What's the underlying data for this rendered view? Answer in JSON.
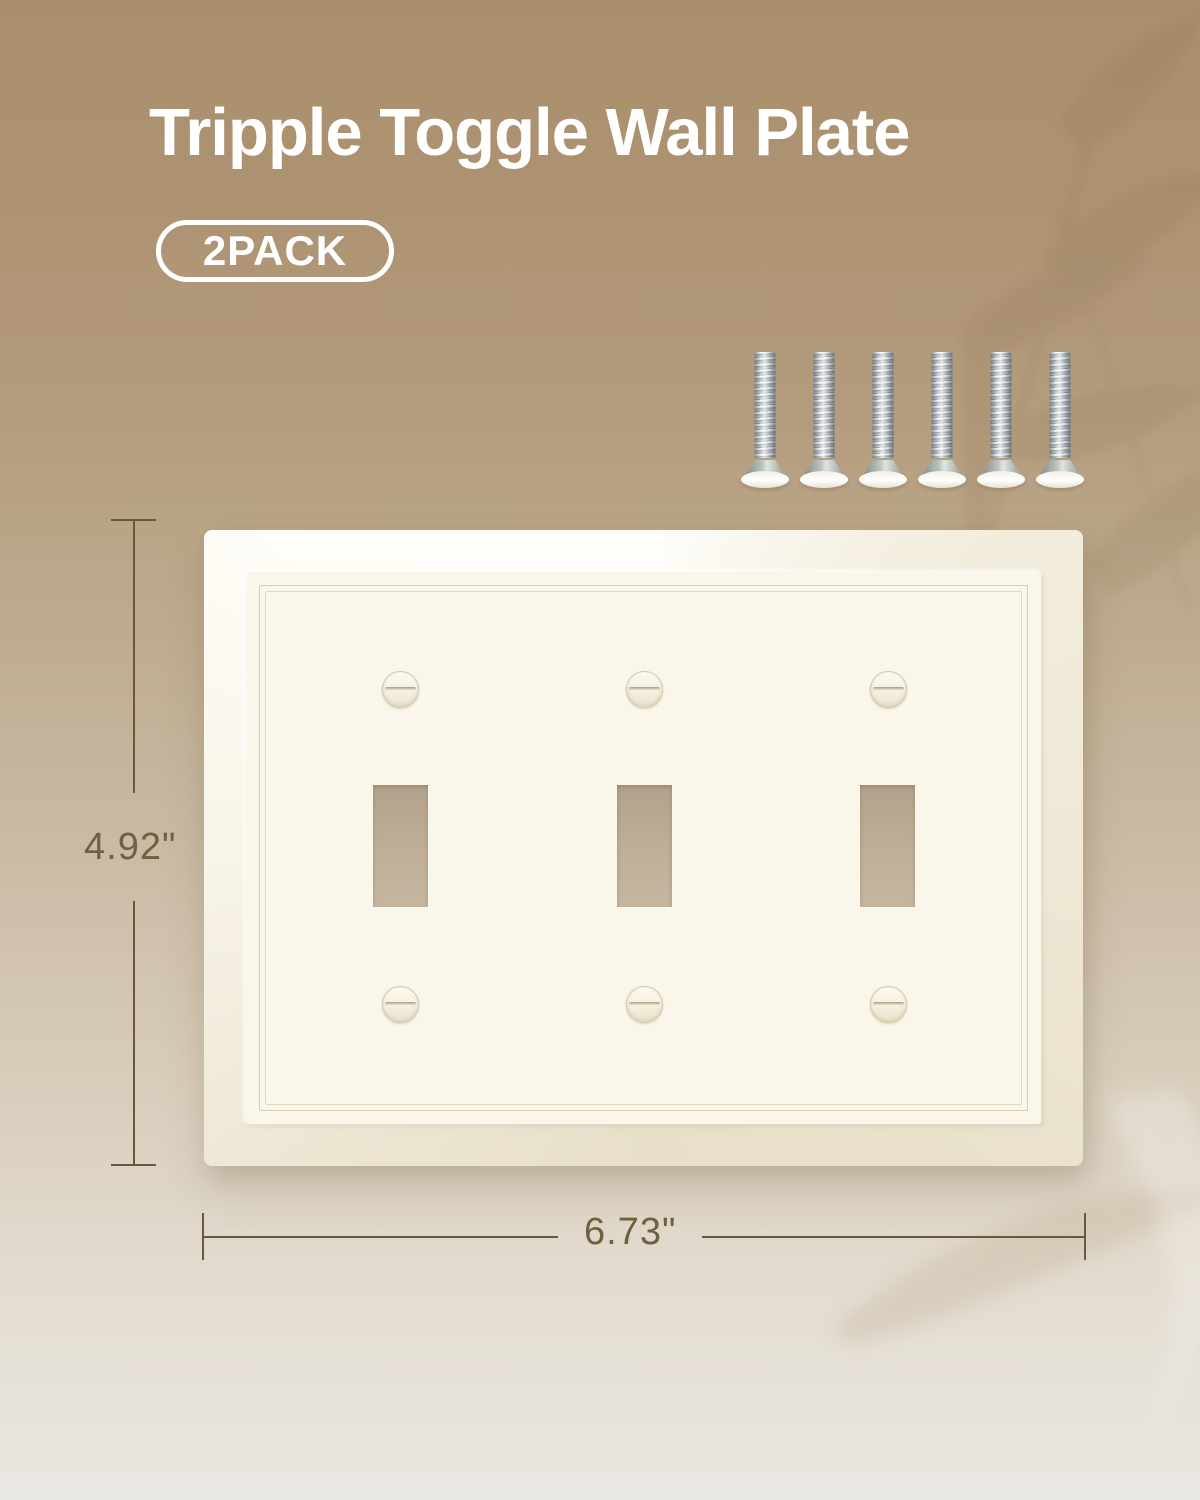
{
  "header": {
    "title": "Tripple Toggle Wall Plate",
    "badge_label": "2PACK"
  },
  "dimensions": {
    "height": "4.92\"",
    "width": "6.73\""
  },
  "product": {
    "type": "triple toggle wall plate",
    "toggle_cutout_count": 3,
    "plate_screw_count": 6,
    "hardware_screw_count": 6
  },
  "colors": {
    "background_top": "#a98f6b",
    "background_bottom": "#eae8e3",
    "plate_face": "#faf6ea",
    "toggle_hole": "#bfae97",
    "dimension_line": "#6b583c",
    "dimension_text": "#70603f",
    "title_text": "#ffffff"
  }
}
